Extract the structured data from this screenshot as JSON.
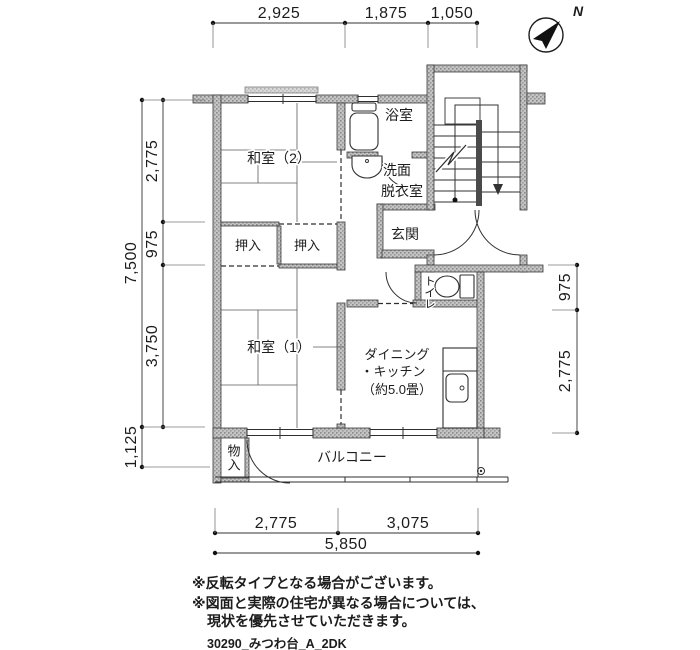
{
  "compass": {
    "north_label": "N"
  },
  "dimensions": {
    "top": [
      "2,925",
      "1,875",
      "1,050"
    ],
    "left_outer": "7,500",
    "left_inner_top": "2,775",
    "left_inner_mid": "975",
    "left_inner_bottom": "3,750",
    "left_balcony": "1,125",
    "right_top": "975",
    "right_bottom": "2,775",
    "bottom_left": "2,775",
    "bottom_right": "3,075",
    "bottom_total": "5,850"
  },
  "rooms": {
    "washitsu2": "和室（2）",
    "washitsu1": "和室（1）",
    "bathroom": "浴室",
    "washroom_line1": "洗面",
    "washroom_line2": "脱衣室",
    "genkan": "玄関",
    "toilet": "トイレ",
    "oshiire_left": "押入",
    "oshiire_right": "押入",
    "dk_line1": "ダイニング",
    "dk_line2": "・キッチン",
    "dk_line3": "（約5.0畳）",
    "monoire": "物入",
    "balcony": "バルコニー"
  },
  "notes": {
    "line1": "※反転タイプとなる場合がございます。",
    "line2": "※図面と実際の住宅が異なる場合については、",
    "line3": "現状を優先させていただきます。",
    "plan_id": "30290_みつわ台_A_2DK"
  },
  "colors": {
    "wall_fill_base": "#c4c4c4",
    "wall_speckle": "#8a8a8a",
    "line": "#2f2f2f"
  }
}
